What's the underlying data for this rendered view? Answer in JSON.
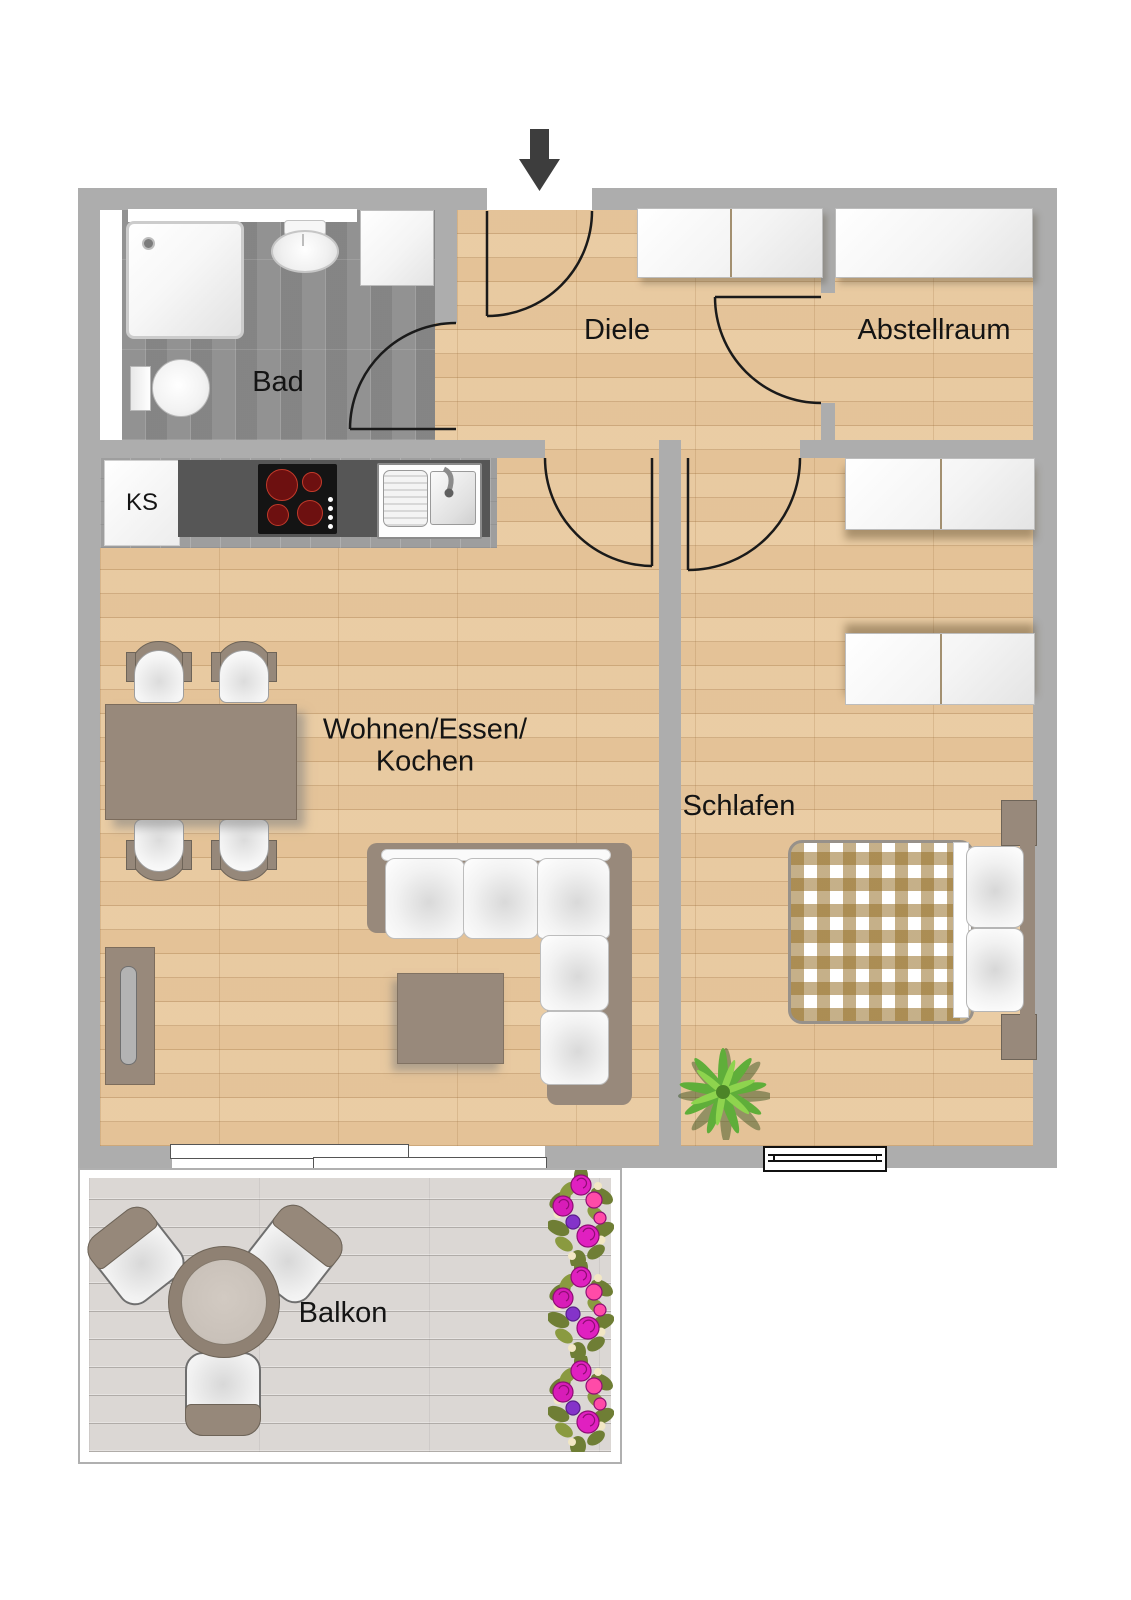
{
  "title": "Apartment floor plan",
  "rooms": {
    "bad": {
      "label": "Bad"
    },
    "diele": {
      "label": "Diele"
    },
    "abstellraum": {
      "label": "Abstellraum"
    },
    "wohnen": {
      "line1": "Wohnen/Essen/",
      "line2": "Kochen"
    },
    "schlafen": {
      "label": "Schlafen"
    },
    "balkon": {
      "label": "Balkon"
    }
  },
  "kitchen": {
    "fridge_label": "KS"
  },
  "icons": [
    "entrance-arrow-icon",
    "plant-icon",
    "flower-cluster-icon"
  ],
  "colors": {
    "wall": "#adadad",
    "wood_floor": "#e8c9a0",
    "bath_floor": "#8f8f8f",
    "kitchen_tile": "#9e9e9e",
    "counter_dark": "#565656",
    "balcony_deck": "#dbd7d4",
    "furniture_taupe": "#98897b",
    "burner_red": "#6d1010",
    "flower_magenta": "#e020c0",
    "flower_pink": "#ff4ba8",
    "flower_purple": "#8433c9",
    "plant_green": "#5fae3a",
    "door_line": "#1a1a1a"
  }
}
